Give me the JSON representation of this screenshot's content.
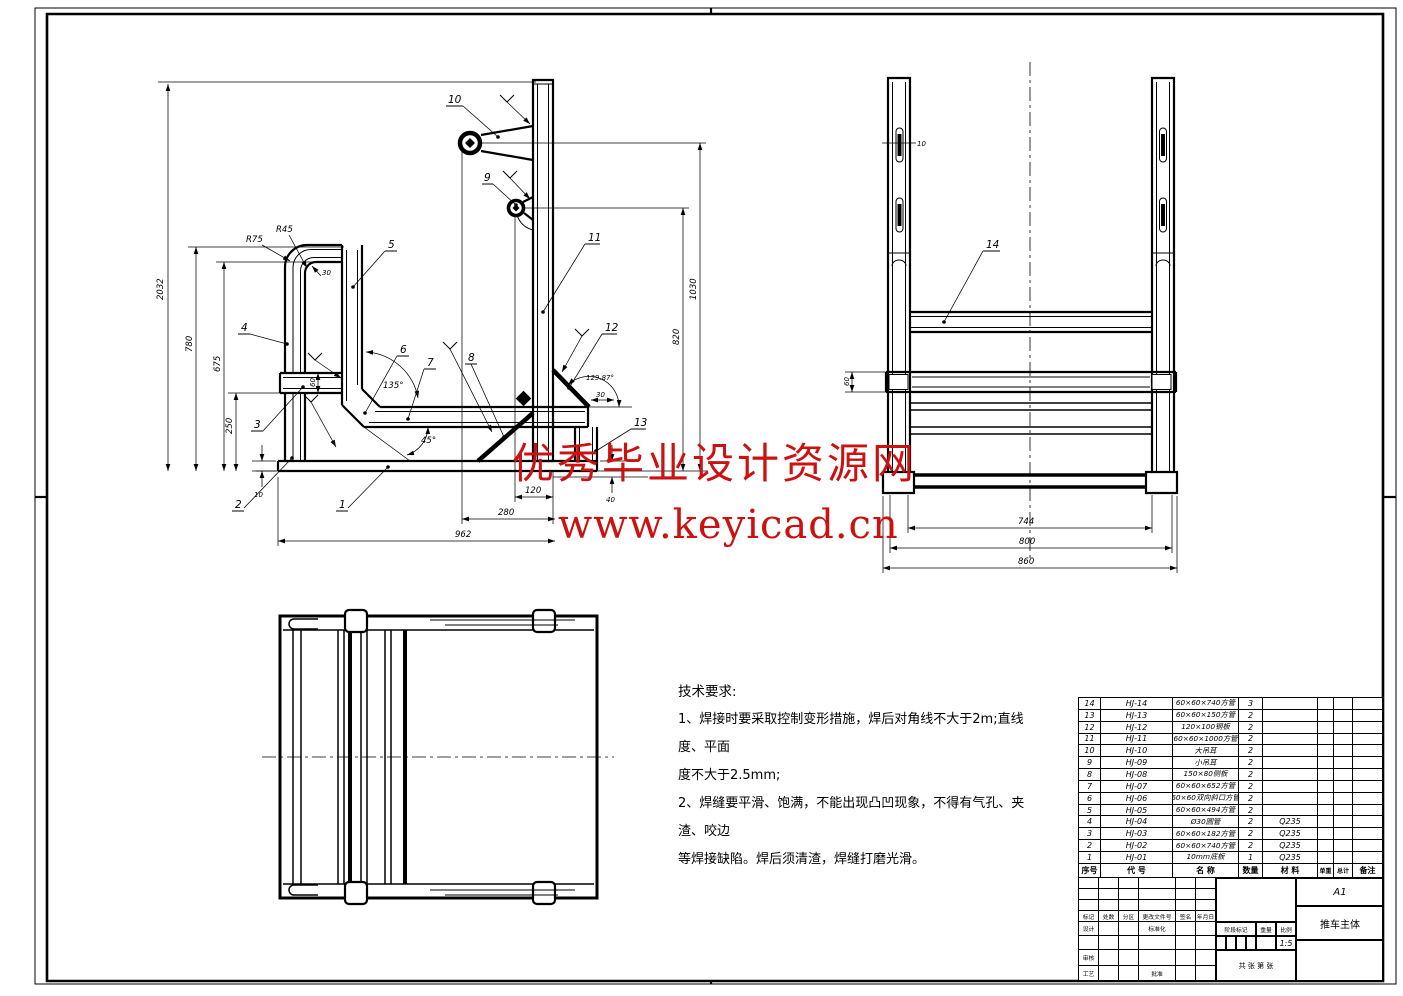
{
  "watermark": {
    "line1": "优秀毕业设计资源网",
    "line2": "www.keyicad.cn",
    "color": "#cc1111"
  },
  "tech_requirements": {
    "title": "技术要求:",
    "line1": "1、焊接时要采取控制变形措施，焊后对角线不大于2m;直线度、平面",
    "line2": "度不大于2.5mm;",
    "line3": "2、焊缝要平滑、饱满，不能出现凸凹现象，不得有气孔、夹渣、咬边",
    "line4": "等焊接缺陷。焊后须清渣，焊缝打磨光滑。"
  },
  "front_view": {
    "balloons": {
      "b1": "1",
      "b2": "2",
      "b3": "3",
      "b4": "4",
      "b5": "5",
      "b6": "6",
      "b7": "7",
      "b8": "8",
      "b9": "9",
      "b10": "10",
      "b11": "11",
      "b12": "12",
      "b13": "13"
    },
    "dims": {
      "total_h": "2032",
      "handle_h": "780",
      "mid_h": "675",
      "lower_h": "250",
      "plate_t": "10",
      "post_w": "60",
      "bend_30": "30",
      "r_outer": "R75",
      "r_inner": "R45",
      "angle_135": "135°",
      "angle_45": "45°",
      "angle_129": "129.87°",
      "offset_30": "30",
      "gap_40": "40",
      "d120": "120",
      "d280": "280",
      "d962": "962",
      "d1030": "1030",
      "d820": "820"
    }
  },
  "side_view": {
    "balloon_14": "14",
    "dims": {
      "slot_10": "10",
      "rail_60": "60",
      "d744": "744",
      "d800": "800",
      "d860": "860"
    }
  },
  "bom": {
    "headers": [
      "序号",
      "代 号",
      "名  称",
      "数量",
      "材  料",
      "单重",
      "总计",
      "备注"
    ],
    "rows": [
      {
        "no": "14",
        "code": "HJ-14",
        "name": "60×60×740方管",
        "qty": "3",
        "material": ""
      },
      {
        "no": "13",
        "code": "HJ-13",
        "name": "60×60×150方管",
        "qty": "2",
        "material": ""
      },
      {
        "no": "12",
        "code": "HJ-12",
        "name": "120×100钢板",
        "qty": "2",
        "material": ""
      },
      {
        "no": "11",
        "code": "HJ-11",
        "name": "60×60×1000方管",
        "qty": "2",
        "material": ""
      },
      {
        "no": "10",
        "code": "HJ-10",
        "name": "大吊耳",
        "qty": "2",
        "material": ""
      },
      {
        "no": "9",
        "code": "HJ-09",
        "name": "小吊耳",
        "qty": "2",
        "material": ""
      },
      {
        "no": "8",
        "code": "HJ-08",
        "name": "150×80侧板",
        "qty": "2",
        "material": ""
      },
      {
        "no": "7",
        "code": "HJ-07",
        "name": "60×60×652方管",
        "qty": "2",
        "material": ""
      },
      {
        "no": "6",
        "code": "HJ-06",
        "name": "60×60双向斜口方管",
        "qty": "2",
        "material": ""
      },
      {
        "no": "5",
        "code": "HJ-05",
        "name": "60×60×494方管",
        "qty": "2",
        "material": ""
      },
      {
        "no": "4",
        "code": "HJ-04",
        "name": "Ø30圆管",
        "qty": "2",
        "material": "Q235"
      },
      {
        "no": "3",
        "code": "HJ-03",
        "name": "60×60×182方管",
        "qty": "2",
        "material": "Q235"
      },
      {
        "no": "2",
        "code": "HJ-02",
        "name": "60×60×740方管",
        "qty": "2",
        "material": "Q235"
      },
      {
        "no": "1",
        "code": "HJ-01",
        "name": "10mm底板",
        "qty": "1",
        "material": "Q235"
      }
    ]
  },
  "title_block": {
    "sheet_size": "A1",
    "part_name": "推车主体",
    "scale": "1:5",
    "sheets": "共  张    第  张",
    "labels": {
      "mark": "标记",
      "count": "处数",
      "zone": "分区",
      "change_doc": "更改文件号",
      "sign": "签名",
      "date": "年月日",
      "design": "设计",
      "standard": "标准化",
      "check": "审核",
      "process": "工艺",
      "approve": "批准",
      "stage": "阶段标记",
      "weight": "重量",
      "ratio": "比例"
    }
  }
}
